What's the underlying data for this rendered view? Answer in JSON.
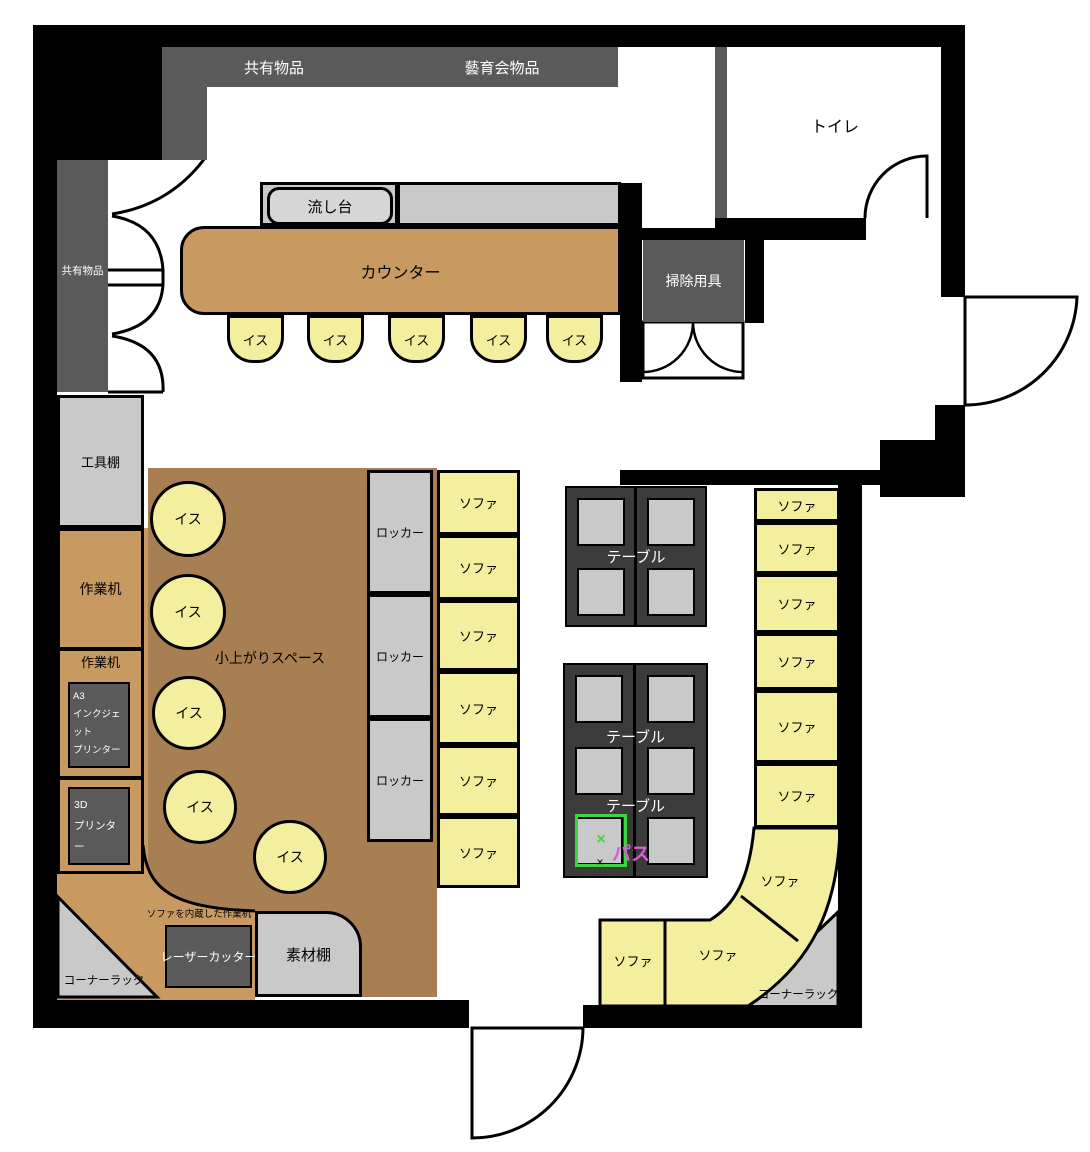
{
  "palette": {
    "wall": "#000000",
    "dark_shelf": "#5a5a5a",
    "table_dark": "#3b3b3b",
    "light_gray": "#c9c9c9",
    "sink_gray": "#d6d6d6",
    "tan": "#c89a62",
    "brown": "#a87e53",
    "yellow": "#f4ee9f",
    "green": "#3ed63e",
    "pink": "#d55fd5"
  },
  "labels": {
    "shared_items": "共有物品",
    "geiiku_items": "藝育会物品",
    "toilet": "トイレ",
    "sink": "流し台",
    "counter": "カウンター",
    "cleaning_supplies": "掃除用具",
    "tool_shelf": "工具棚",
    "work_desk": "作業机",
    "raised_floor_space": "小上がりスペース",
    "chair": "イス",
    "locker": "ロッカー",
    "sofa": "ソファ",
    "table": "テーブル",
    "a3_printer": [
      "A3",
      "インクジェット",
      "プリンター"
    ],
    "printer_3d": [
      "3D",
      "プリンター"
    ],
    "laser_cutter": "レーザーカッター",
    "material_shelf": "素材棚",
    "sofa_builtin_desk": "ソファを内蔵した作業机",
    "corner_rack": "コーナーラック",
    "pass": "パス",
    "cross": "×"
  },
  "inventory": {
    "counter_chairs": 5,
    "floor_chairs": 5,
    "lockers": 3,
    "left_sofa_units": 6,
    "right_sofa_units": 9,
    "table_cluster_1_cells": 4,
    "table_cluster_2_cells": 6,
    "highlighted_cell": {
      "marker": "パス",
      "position": "table-cluster-2 bottom-left",
      "border_color": "#3ed63e",
      "text_color": "#d55fd5"
    }
  }
}
